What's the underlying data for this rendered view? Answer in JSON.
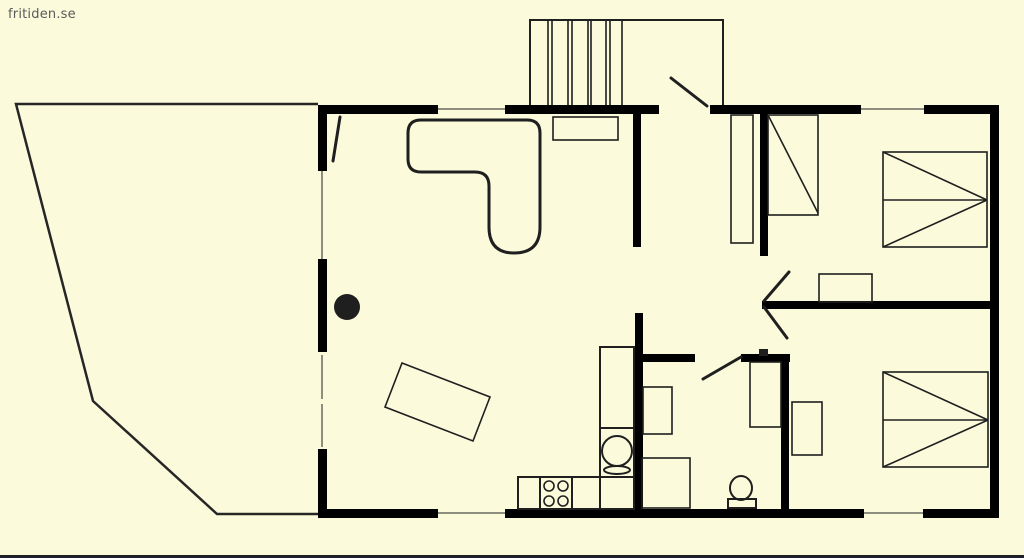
{
  "watermark": {
    "text": "fritiden.se"
  },
  "colors": {
    "background": "#fbfbdc",
    "wall": "#000000",
    "furniture_line": "#1f1f1f",
    "window_line": "#8d8d80",
    "deck_line": "#262626",
    "watermark_text": "#5a5a5a",
    "bottom_edge": "#202028"
  },
  "icons": {
    "staircase-icon": "rectangle with parallel tread lines",
    "entry-door-swing-icon": "diagonal leaf line at top entrance",
    "terrace-door-swing-icon": "diagonal leaf line on left wall",
    "corner-sofa-icon": "rounded L-shape outline",
    "wood-stove-icon": "solid black circle",
    "dining-table-icon": "rotated rectangle outline",
    "sideboard-icon": "small rectangle under stairs",
    "wardrobe-icon": "tall narrow rectangle in hall",
    "single-bed-icon": "rectangle with one diagonal",
    "double-bed-icon": "rectangle with midline and two converging diagonals",
    "nightstand-icon": "small rectangle beside bed",
    "kitchen-counter-icon": "row of counter cells along wall",
    "stove-burners-icon": "four small circles in counter cell",
    "kitchen-sink-icon": "circle with oval drain below",
    "washbasin-icon": "small rectangle on bathroom wall",
    "bathroom-cabinet-icon": "square outline in bathroom corner",
    "toilet-icon": "ellipse bowl on rectangular tank base",
    "window-icon": "thin gray line in wall gap",
    "deck-outline-icon": "angled polyline around left terrace"
  }
}
